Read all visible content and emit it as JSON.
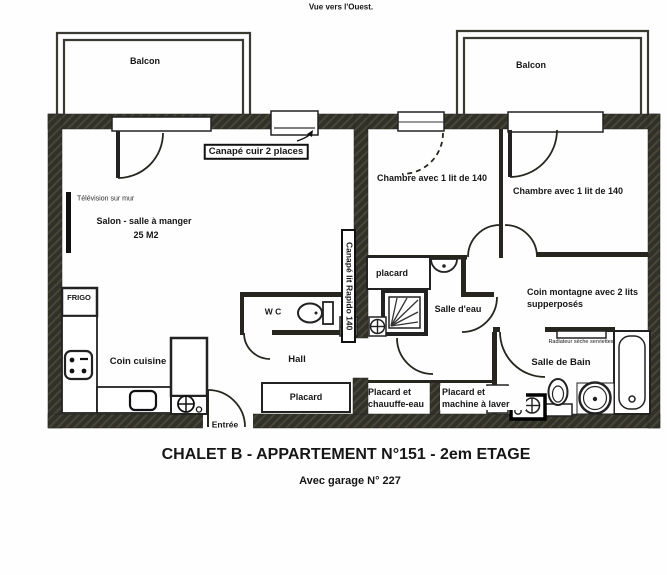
{
  "caption": "Vue vers l'Ouest.",
  "title": "CHALET B - APPARTEMENT N°151 - 2em ETAGE",
  "subtitle": "Avec garage N° 227",
  "labels": {
    "balcony_left": "Balcon",
    "balcony_right": "Balcon",
    "sofa_leather": "Canapé cuir 2 places",
    "sofa_bed": "Canapé lit Rapido 140",
    "tv": "Télévision sur mur",
    "living_room": "Salon - salle à manger",
    "living_room_area": "25 M2",
    "bedroom_1": "Chambre avec 1 lit de 140",
    "bedroom_2": "Chambre avec 1 lit de 140",
    "closet_upper": "placard",
    "shower_room": "Salle d'eau",
    "mountain_corner": "Coin montagne avec 2 lits supperposés",
    "towel_radiator": "Radiateur sèche serviettes",
    "bathroom": "Salle de Bain",
    "fridge": "FRIGO",
    "kitchen": "Coin cuisine",
    "wc": "W C",
    "hall": "Hall",
    "closet_hall": "Placard",
    "closet_heater": "Placard et chauuffe-eau",
    "closet_washer": "Placard et machine à laver",
    "entrance": "Entrée"
  },
  "colors": {
    "wall": "#31312a",
    "ink": "#161616",
    "paper": "#fefefe"
  }
}
